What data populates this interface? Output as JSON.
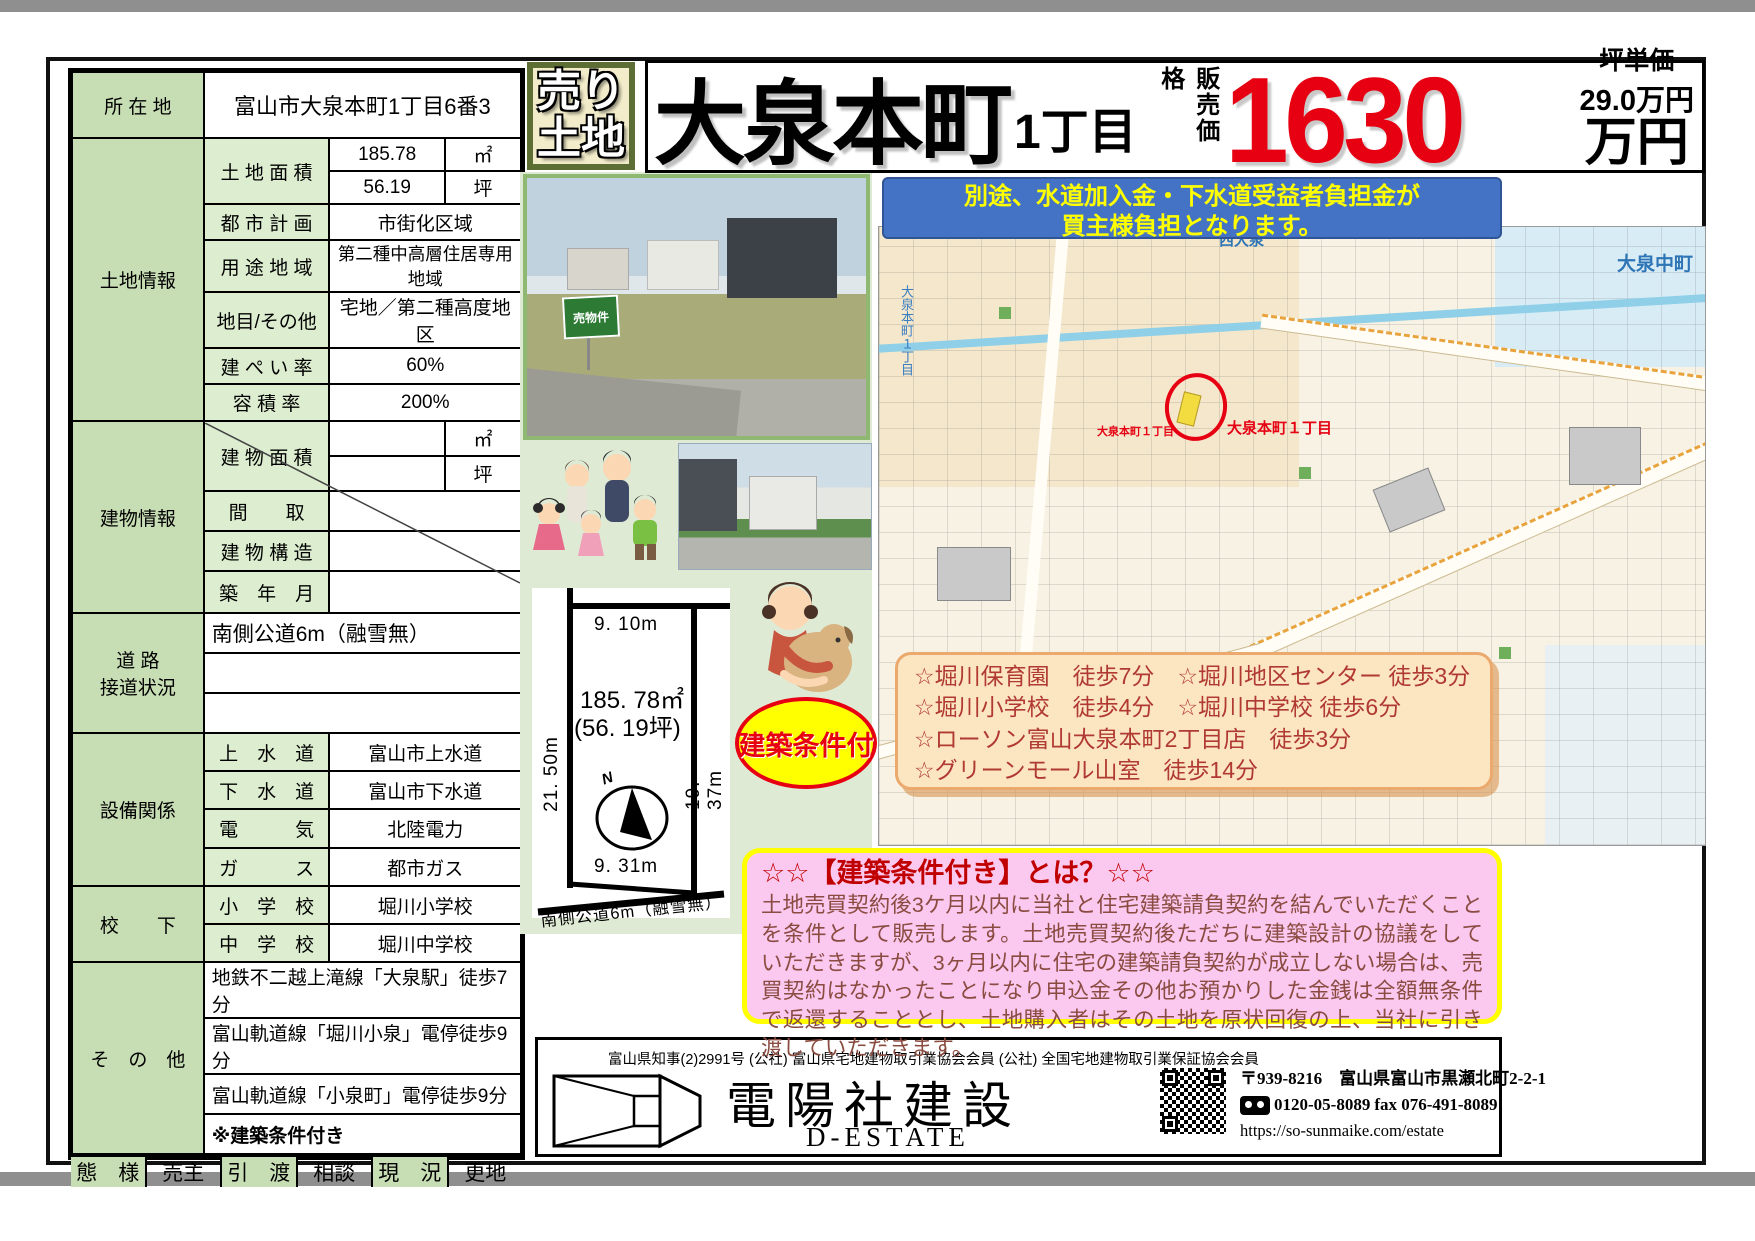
{
  "badge": {
    "line1": "売り",
    "line2": "土地"
  },
  "title": {
    "name": "大泉本町",
    "chome": "1丁目",
    "price_label": "販売価格",
    "price": "1630",
    "tsubo_label": "坪単価",
    "tsubo_price": "29.0万円",
    "price_unit": "万円"
  },
  "notice": {
    "line1": "別途、水道加入金・下水道受益者負担金が",
    "line2": "買主様負担となります。"
  },
  "table": {
    "location_label": "所 在 地",
    "location": "富山市大泉本町1丁目6番3",
    "land_label": "土地情報",
    "land_area_label": "土 地 面 積",
    "land_area_m2": "185.78",
    "unit_m2": "㎡",
    "land_area_tsubo": "56.19",
    "unit_tsubo": "坪",
    "plan_label": "都 市 計 画",
    "plan": "市街化区域",
    "zoning_label": "用 途 地 域",
    "zoning": "第二種中高層住居専用地域",
    "category_label": "地目/その他",
    "category": "宅地／第二種高度地区",
    "coverage_label": "建 ぺ い 率",
    "coverage": "60%",
    "far_label": "容 積 率",
    "far": "200%",
    "building_label": "建物情報",
    "building_area_label": "建 物 面 積",
    "madori_label": "間　　取",
    "structure_label": "建 物 構 造",
    "built_label": "築　年　月",
    "road_label": "道 路\n接道状況",
    "road": "南側公道6m（融雪無）",
    "util_label": "設備関係",
    "water_label": "上　水　道",
    "water": "富山市上水道",
    "sewer_label": "下　水　道",
    "sewer": "富山市下水道",
    "elec_label": "電　　　気",
    "elec": "北陸電力",
    "gas_label": "ガ　　　ス",
    "gas": "都市ガス",
    "school_label": "校　　下",
    "elem_label": "小　学　校",
    "elem": "堀川小学校",
    "junior_label": "中　学　校",
    "junior": "堀川中学校",
    "other_label": "そ　の　他",
    "other1": "地鉄不二越上滝線「大泉駅」徒歩7分",
    "other2": "富山軌道線「堀川小泉」電停徒歩9分",
    "other3": "富山軌道線「小泉町」電停徒歩9分",
    "other4": "※建築条件付き",
    "mode_label": "態　様",
    "mode": "売主",
    "handover_label": "引　渡",
    "handover": "相談",
    "current_label": "現　況",
    "current": "更地"
  },
  "photos": {
    "sign": "売物件"
  },
  "map": {
    "label_ne": "大泉中町",
    "label_n": "西大泉",
    "label_site": "大泉本町１丁目",
    "label_site_small": "大泉本町１丁目",
    "label_vertical": "大泉本町１丁目"
  },
  "access": {
    "lines": [
      "☆堀川保育園　徒歩7分　☆堀川地区センター 徒歩3分",
      "☆堀川小学校　徒歩4分　☆堀川中学校 徒歩6分",
      "☆ローソン富山大泉本町2丁目店　徒歩3分",
      "☆グリーンモール山室　徒歩14分"
    ]
  },
  "condition": {
    "badge": "建築条件付",
    "heading": "☆☆【建築条件付き】とは？☆☆",
    "body": "土地売買契約後3ケ月以内に当社と住宅建築請負契約を結んでいただくことを条件として販売します。土地売買契約後ただちに建築設計の協議をしていただきますが、3ヶ月以内に住宅の建築請負契約が成立しない場合は、売買契約はなかったことになり申込金その他お預かりした金銭は全額無条件で返還することとし、土地購入者はその土地を原状回復の上、当社に引き渡していただきます。"
  },
  "diagram": {
    "top": "9. 10m",
    "left": "21. 50m",
    "right": "19. 37m",
    "bottom": "9. 31m",
    "area": "185. 78㎡",
    "tsubo": "(56. 19坪)",
    "north": "N",
    "road": "南側公道6m（融雪無）"
  },
  "footer": {
    "license": "富山県知事(2)2991号 (公社) 富山県宅地建物取引業協会会員 (公社) 全国宅地建物取引業保証協会会員",
    "company": "電陽社建設",
    "brand": "D-ESTATE",
    "postal": "〒939-8216　富山県富山市黒瀬北町2-2-1",
    "phone": "0120-05-8089",
    "fax": "fax 076-491-8089",
    "url": "https://so-sunmaike.com/estate"
  },
  "colors": {
    "accent_red": "#e60012",
    "banner_blue": "#4472c4",
    "highlight_yellow": "#ffff00",
    "table_green": "#c7ddb4",
    "pink_box": "#fbc9ef",
    "access_cream": "#fce6c2"
  }
}
